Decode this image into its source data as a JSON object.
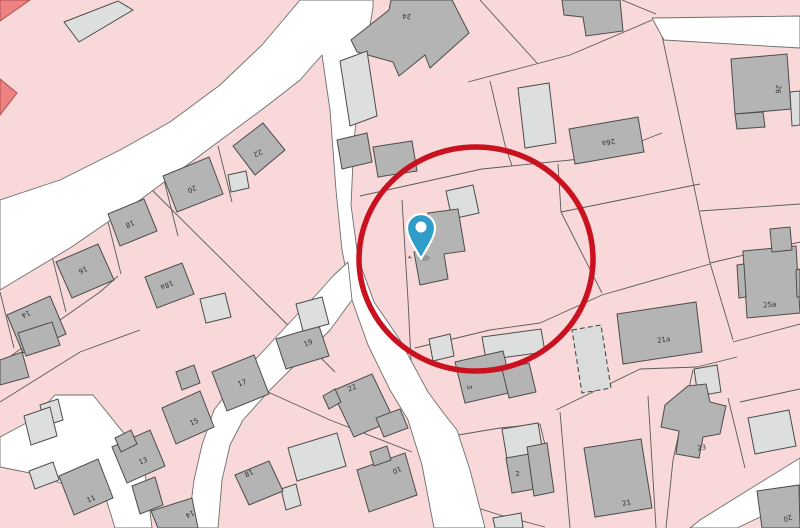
{
  "map": {
    "background_color": "#f8d8d8",
    "road_color": "#ffffff",
    "road_edge_color": "#6e6e6e",
    "parcel_line_color": "#5a5a5a",
    "building_fill_gray": "#b4b4b4",
    "building_fill_light": "#dddfdf",
    "building_fill_red": "#ee8181",
    "building_stroke": "#4c4c4c",
    "label_color": "#333333",
    "roads": [
      {
        "name": "road-main-north-and-center",
        "points": "300,0 373,0 373,8 362,70 354,140 351,205 358,258 374,302 400,340 428,392 445,415 457,430 470,470 483,520 485,528 434,528 422,465 408,420 390,390 368,345 352,300 342,250 336,190 330,110 322,55 300,80 268,105 210,148 140,200 70,248 0,290 0,200 60,180 120,150 170,122 220,85 262,45"
      },
      {
        "name": "road-southwest",
        "points": "55,395 93,395 143,457 152,528 115,528 104,492 92,470 60,483 30,473 0,467 0,437 32,420"
      },
      {
        "name": "road-south-branch",
        "points": "348,262 352,300 330,330 300,360 270,390 243,420 230,445 222,480 218,528 188,528 194,480 202,445 214,410 238,378 266,348 292,320 316,295 334,275"
      },
      {
        "name": "road-southeast",
        "points": "800,458 745,492 700,520 690,528 737,528 758,518 800,498"
      },
      {
        "name": "road-northeast",
        "points": "652,18 800,16 800,48 664,40"
      }
    ],
    "parcel_lines": [
      "218,146 232,202",
      "164,180 178,236",
      "107,218 121,274",
      "52,256 66,312",
      "0,292 14,348",
      "146,184 335,372",
      "0,364 60,320 100,292 118,276",
      "140,330 80,352 0,402",
      "268,392 330,420 412,452",
      "402,200 408,300 411,360",
      "360,196 482,169 600,157 662,133",
      "480,0 537,63",
      "468,82 570,55 652,20",
      "490,81 505,145 512,166",
      "658,17 680,120 710,263 733,340",
      "700,211 800,204",
      "561,212 700,184",
      "558,164 561,212 602,293",
      "540,323 602,295 710,264",
      "710,263 800,242",
      "733,342 800,324",
      "415,348 490,330 540,323",
      "556,410 640,369 697,367 737,357",
      "648,396 656,528",
      "560,412 570,528",
      "693,370 673,460 666,528",
      "728,398 745,468",
      "452,436 500,428 540,424",
      "540,424 551,470",
      "452,500 500,515 545,527",
      "740,402 800,389",
      "622,0 656,14"
    ],
    "buildings": [
      {
        "c": "red",
        "p": "0,0 30,0 0,21"
      },
      {
        "c": "red",
        "p": "0,79 17,93 0,115"
      },
      {
        "c": "lg",
        "p": "64,22 118,1 133,10 79,42"
      },
      {
        "c": "g",
        "p": "233,146 263,123 285,150 255,175"
      },
      {
        "c": "lg",
        "p": "228,175 246,171 249,188 231,192"
      },
      {
        "c": "g",
        "p": "163,176 209,157 223,194 177,212"
      },
      {
        "c": "g",
        "p": "108,214 144,199 157,231 120,246"
      },
      {
        "c": "g",
        "p": "56,262 98,244 114,280 72,298"
      },
      {
        "c": "g",
        "p": "145,277 182,263 194,294 157,308"
      },
      {
        "c": "g",
        "p": "7,315 50,296 66,334 23,353"
      },
      {
        "c": "g",
        "p": "18,333 52,322 60,345 26,356"
      },
      {
        "c": "g",
        "p": "0,360 22,352 29,377 0,385"
      },
      {
        "c": "lg",
        "p": "40,405 58,399 63,420 45,426"
      },
      {
        "c": "lg",
        "p": "24,416 50,407 57,436 31,445"
      },
      {
        "c": "lg",
        "p": "29,471 53,462 59,480 35,489"
      },
      {
        "c": "g",
        "p": "212,372 254,355 269,394 227,411"
      },
      {
        "c": "g",
        "p": "176,372 194,365 200,383 182,390"
      },
      {
        "c": "g",
        "p": "162,408 200,391 214,427 176,444"
      },
      {
        "c": "g",
        "p": "112,447 150,430 165,466 127,483"
      },
      {
        "c": "g",
        "p": "115,438 131,430 137,444 121,452"
      },
      {
        "c": "g",
        "p": "132,486 155,477 163,505 140,514"
      },
      {
        "c": "g",
        "p": "59,476 98,459 113,498 74,515"
      },
      {
        "c": "g",
        "p": "276,339 319,326 329,356 286,369"
      },
      {
        "c": "lg",
        "p": "296,304 322,297 329,324 303,331"
      },
      {
        "c": "lg",
        "p": "200,299 225,293 231,317 206,323"
      },
      {
        "c": "g",
        "p": "332,391 372,374 394,420 354,437"
      },
      {
        "c": "g",
        "p": "323,396 335,389 341,402 329,409"
      },
      {
        "c": "g",
        "p": "376,418 400,409 408,428 384,437"
      },
      {
        "c": "lg",
        "p": "288,448 337,433 346,466 297,481"
      },
      {
        "c": "lg",
        "p": "281,489 296,484 301,505 286,510"
      },
      {
        "c": "g",
        "p": "235,475 269,461 283,491 249,505"
      },
      {
        "c": "g",
        "p": "151,511 192,498 198,528 158,528"
      },
      {
        "c": "g",
        "p": "357,470 405,453 417,495 369,512"
      },
      {
        "c": "g",
        "p": "370,452 387,446 391,460 374,466"
      },
      {
        "c": "g",
        "p": "351,40 389,10 391,0 452,0 469,33 430,68 425,55 399,76 393,62 357,52"
      },
      {
        "c": "lg",
        "p": "340,61 367,51 377,116 350,126"
      },
      {
        "c": "g",
        "p": "337,140 367,133 372,162 342,169"
      },
      {
        "c": "g",
        "p": "562,0 620,0 623,31 586,36 583,17 564,15"
      },
      {
        "c": "lg",
        "p": "518,88 549,83 556,143 525,148"
      },
      {
        "c": "g",
        "p": "569,129 638,117 644,152 575,164"
      },
      {
        "c": "g",
        "p": "731,59 787,54 791,109 735,114"
      },
      {
        "c": "g",
        "p": "735,114 763,112 765,127 737,129"
      },
      {
        "c": "lg",
        "p": "790,92 800,91 800,125 792,126"
      },
      {
        "c": "g",
        "p": "743,251 796,246 800,313 747,318"
      },
      {
        "c": "g",
        "p": "770,229 790,227 792,250 772,252"
      },
      {
        "c": "g",
        "p": "737,265 744,264 746,297 739,298"
      },
      {
        "c": "g",
        "p": "796,270 800,269 800,297 797,297"
      },
      {
        "c": "g",
        "p": "617,314 696,302 702,352 623,364"
      },
      {
        "c": "lg",
        "p": "694,369 717,365 721,392 698,396"
      },
      {
        "c": "lg",
        "p": "748,418 789,410 796,446 755,454"
      },
      {
        "c": "g",
        "p": "665,405 688,386 706,384 710,402 726,406 720,434 703,437 699,458 676,454 679,431 661,427"
      },
      {
        "c": "g",
        "p": "584,448 641,439 652,508 595,517"
      },
      {
        "c": "lg",
        "p": "482,337 541,329 545,352 486,360"
      },
      {
        "c": "lg",
        "p": "429,339 450,334 454,356 433,361"
      },
      {
        "c": "g",
        "p": "455,362 503,351 513,392 465,403"
      },
      {
        "c": "g",
        "p": "502,369 529,363 536,392 509,398"
      },
      {
        "c": "lg",
        "p": "502,429 538,423 543,453 507,459"
      },
      {
        "c": "g",
        "p": "506,458 535,453 541,488 512,493"
      },
      {
        "c": "g",
        "p": "527,447 547,443 554,492 534,496"
      },
      {
        "c": "lg",
        "p": "493,518 521,513 523,528 495,528"
      },
      {
        "c": "g",
        "p": "757,491 799,485 800,528 762,528"
      },
      {
        "c": "lg",
        "p": "446,191 473,185 479,213 452,219"
      },
      {
        "c": "g",
        "p": "428,213 458,209 465,251 444,254 448,279 420,285 414,252 426,250"
      },
      {
        "c": "g",
        "p": "373,147 412,141 417,171 378,177"
      },
      {
        "c": "dash",
        "p": "572,330 601,325 611,388 582,393"
      }
    ],
    "labels": [
      {
        "t": "22",
        "x": 257,
        "y": 151,
        "r": 155
      },
      {
        "t": "20",
        "x": 191,
        "y": 187,
        "r": 155
      },
      {
        "t": "18",
        "x": 129,
        "y": 222,
        "r": 155
      },
      {
        "t": "16",
        "x": 82,
        "y": 268,
        "r": 155
      },
      {
        "t": "18a",
        "x": 166,
        "y": 283,
        "r": 155
      },
      {
        "t": "14",
        "x": 25,
        "y": 312,
        "r": 155
      },
      {
        "t": "24",
        "x": 407,
        "y": 14,
        "r": 185
      },
      {
        "t": "26a",
        "x": 608,
        "y": 140,
        "r": 168
      },
      {
        "t": "26",
        "x": 776,
        "y": 89,
        "r": 95
      },
      {
        "t": "25a",
        "x": 770,
        "y": 307,
        "r": -5
      },
      {
        "t": "21a",
        "x": 664,
        "y": 342,
        "r": -8
      },
      {
        "t": "23",
        "x": 702,
        "y": 450,
        "r": -10
      },
      {
        "t": "21",
        "x": 627,
        "y": 505,
        "r": -12
      },
      {
        "t": "2",
        "x": 518,
        "y": 476,
        "r": -10
      },
      {
        "t": "5",
        "x": 467,
        "y": 387,
        "r": 100
      },
      {
        "t": "4",
        "x": 408,
        "y": 257,
        "r": 100,
        "s": 5
      },
      {
        "t": "17",
        "x": 243,
        "y": 385,
        "r": -23
      },
      {
        "t": "15",
        "x": 195,
        "y": 424,
        "r": -23
      },
      {
        "t": "13",
        "x": 144,
        "y": 463,
        "r": -23
      },
      {
        "t": "11",
        "x": 92,
        "y": 501,
        "r": -23
      },
      {
        "t": "19",
        "x": 309,
        "y": 345,
        "r": -23
      },
      {
        "t": "22",
        "x": 353,
        "y": 390,
        "r": -23
      },
      {
        "t": "18",
        "x": 248,
        "y": 471,
        "r": 155
      },
      {
        "t": "14",
        "x": 189,
        "y": 512,
        "r": 155
      },
      {
        "t": "10",
        "x": 396,
        "y": 468,
        "r": 155
      },
      {
        "t": "20",
        "x": 787,
        "y": 516,
        "r": 160
      }
    ]
  },
  "annotation": {
    "circle": {
      "cx": 476,
      "cy": 259,
      "rx": 117,
      "ry": 112,
      "color": "#c9111f",
      "stroke_width": 5.5
    }
  },
  "marker": {
    "pin_color": "#2f9dc8",
    "pin_outline": "#ffffff",
    "tip_x": 421,
    "tip_y": 259,
    "head_cy": 228,
    "head_r": 14,
    "hole_r": 5.5
  }
}
